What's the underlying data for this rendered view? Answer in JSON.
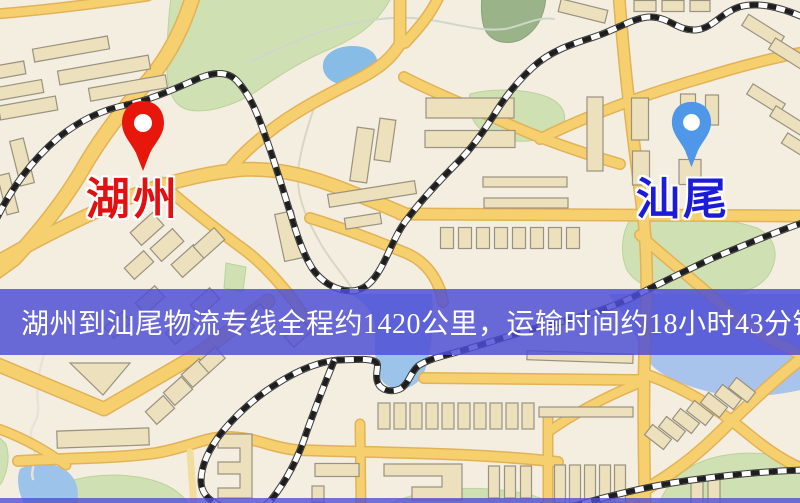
{
  "page": {
    "kind": "logistics-route-map",
    "width": 800,
    "height": 503
  },
  "banner": {
    "text": "湖州到汕尾物流专线全程约1420公里，运输时间约18小时43分钟.",
    "background": "rgba(77,77,213,0.84)",
    "text_color": "#ffffff"
  },
  "pins": {
    "origin": {
      "label": "湖州",
      "pin_color": "#e8170c",
      "label_color": "#e21010",
      "x": 143,
      "y": 171
    },
    "destination": {
      "label": "汕尾",
      "pin_color": "#4f97e8",
      "label_color": "#1c1cd8",
      "x": 691,
      "y": 167
    }
  },
  "route": {
    "origin": "湖州",
    "destination": "汕尾",
    "distance_km": "1420",
    "duration": "18小时43分钟"
  },
  "map_palette": {
    "background": "#f4eee0",
    "road_yellow": "#f6d06e",
    "road_casing": "#e2b258",
    "park_green": "#cfe0b2",
    "water_blue": "#86bce6",
    "building_fill": "#ece0bd",
    "building_stroke": "#9a9280",
    "railway_dark": "#1e1e1e"
  }
}
